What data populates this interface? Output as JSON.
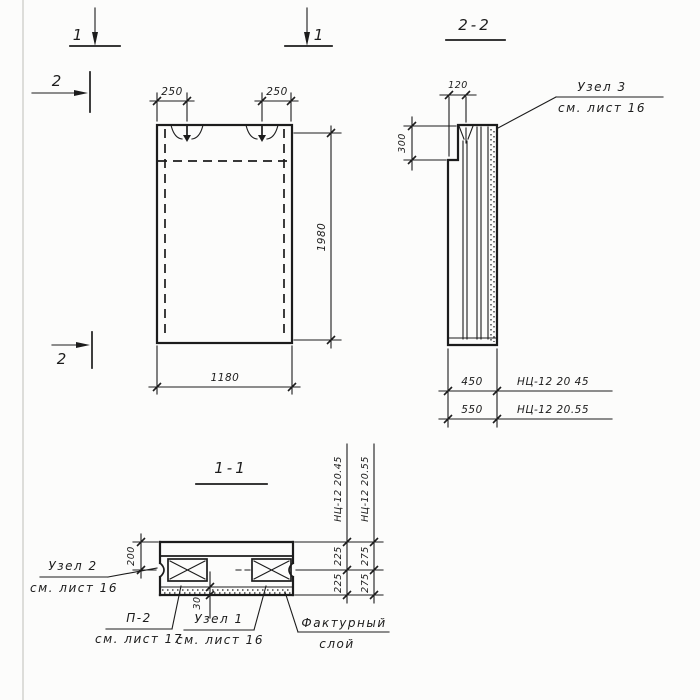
{
  "colors": {
    "ink": "#1c1c1c",
    "paper": "#fcfcfb"
  },
  "section_markers": {
    "cut1_left": "1",
    "cut1_right": "1",
    "cut2_top": "2",
    "cut2_bottom": "2"
  },
  "front_view": {
    "dim_loop_left": "250",
    "dim_loop_right": "250",
    "dim_height": "1980",
    "dim_width": "1180"
  },
  "section_2_2": {
    "title": "2-2",
    "dim_step_width": "120",
    "dim_step_height": "300",
    "rows": [
      {
        "dim": "450",
        "mark": "НЦ-12 20 45"
      },
      {
        "dim": "550",
        "mark": "НЦ-12 20.55"
      }
    ],
    "callout_node3": {
      "title": "Узел 3",
      "ref": "см. лист 16"
    }
  },
  "section_1_1": {
    "title": "1-1",
    "dim_top": "200",
    "dim_facing": "30",
    "columns": [
      {
        "mark": "НЦ-12 20.45",
        "dim_a": "225",
        "dim_b": "225"
      },
      {
        "mark": "НЦ-12 20.55",
        "dim_a": "275",
        "dim_b": "275"
      }
    ],
    "callout_node2": {
      "title": "Узел 2",
      "ref": "см. лист 16"
    },
    "callout_p2": {
      "title": "П-2",
      "ref": "см. лист 17"
    },
    "callout_node1": {
      "title": "Узел 1",
      "ref": "см. лист 16"
    },
    "callout_facing": {
      "title": "Фактурный",
      "ref": "слой"
    }
  }
}
